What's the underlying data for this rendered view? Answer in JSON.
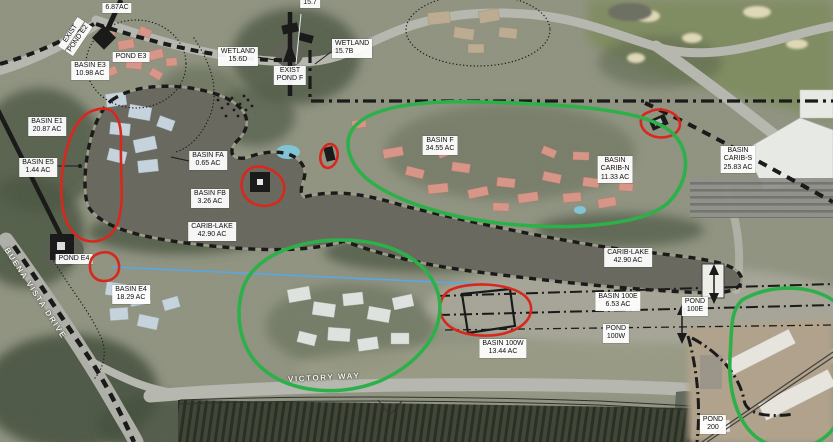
{
  "map": {
    "type": "aerial-drainage-basin-plan",
    "colors": {
      "annotation_red": "#d8281e",
      "annotation_green": "#2db04a",
      "annotation_blue": "#5aa7e6",
      "boundary_black": "#141414"
    }
  },
  "labels": {
    "exist_pond_e2": {
      "l1": "EXIST",
      "l2": "POND E2"
    },
    "pond_687": {
      "l1": "6.87AC"
    },
    "pond_e3": {
      "l1": "POND E3"
    },
    "basin_e3": {
      "l1": "BASIN E3",
      "l2": "10.98 AC"
    },
    "basin_e1": {
      "l1": "BASIN E1",
      "l2": "20.87 AC"
    },
    "basin_e5": {
      "l1": "BASIN E5",
      "l2": "1.44 AC"
    },
    "basin_fa": {
      "l1": "BASIN FA",
      "l2": "0.65 AC"
    },
    "basin_fb": {
      "l1": "BASIN FB",
      "l2": "3.26 AC"
    },
    "carib_lake_w": {
      "l1": "CARIB-LAKE",
      "l2": "42.90 AC"
    },
    "wetland_156d": {
      "l1": "WETLAND",
      "l2": "15.6D"
    },
    "exist_pond_f": {
      "l1": "EXIST",
      "l2": "POND F"
    },
    "wetland_157b": {
      "l1": "WETLAND",
      "l2": "15.7B"
    },
    "wetland_157": {
      "l1": "15.7"
    },
    "basin_f": {
      "l1": "BASIN F",
      "l2": "34.55 AC"
    },
    "basin_carib_n": {
      "l1": "BASIN",
      "l2": "CARIB-N",
      "l3": "11.33 AC"
    },
    "basin_carib_s": {
      "l1": "BASIN",
      "l2": "CARIB-S",
      "l3": "25.83 AC"
    },
    "carib_lake_e": {
      "l1": "CARIB-LAKE",
      "l2": "42.90 AC"
    },
    "basin_100e": {
      "l1": "BASIN 100E",
      "l2": "6.53 AC"
    },
    "pond_100e": {
      "l1": "POND",
      "l2": "100E"
    },
    "pond_100w": {
      "l1": "POND",
      "l2": "100W"
    },
    "basin_100w": {
      "l1": "BASIN 100W",
      "l2": "13.44 AC"
    },
    "basin_e4": {
      "l1": "BASIN E4",
      "l2": "18.29 AC"
    },
    "pond_e4": {
      "l1": "POND E4"
    },
    "pond_200": {
      "l1": "POND",
      "l2": "200"
    }
  },
  "roads": {
    "buena_vista_drive": "BUENA VISTA DRIVE",
    "victory_way": "VICTORY WAY"
  }
}
